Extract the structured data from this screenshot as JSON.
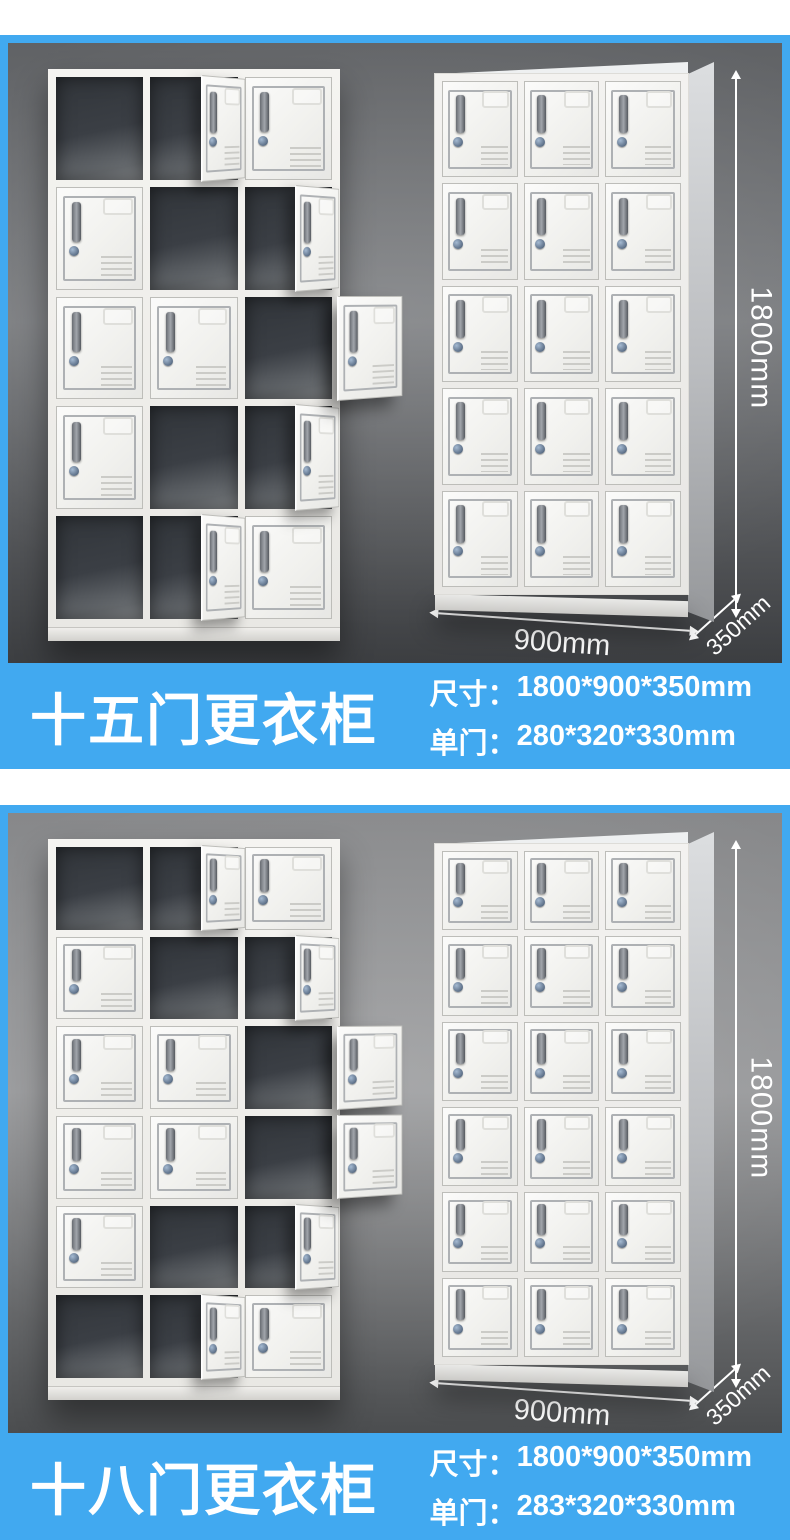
{
  "theme": {
    "banner_blue": "#41a9f0",
    "text_white": "#ffffff",
    "panel1_top": "#606265",
    "panel1_mid": "#7b7d80",
    "panel1_bottom": "#3c3e41",
    "panel2_top": "#87888a",
    "panel2_mid": "#97989a",
    "panel2_bottom": "#4b4d4f"
  },
  "sections": [
    {
      "title": "十五门更衣柜",
      "specs": [
        {
          "label": "尺寸：",
          "value": "1800*900*350mm"
        },
        {
          "label": "单门：",
          "value": "280*320*330mm"
        }
      ],
      "dimensions": {
        "height": "1800mm",
        "width": "900mm",
        "depth": "350mm"
      },
      "open_locker": {
        "cols": 3,
        "rows": 5,
        "cells": [
          [
            "open",
            "ajar",
            "closed"
          ],
          [
            "closed",
            "open",
            "ajar"
          ],
          [
            "closed",
            "closed",
            "swung"
          ],
          [
            "closed",
            "open",
            "ajar"
          ],
          [
            "open",
            "ajar",
            "closed"
          ]
        ]
      },
      "closed_locker": {
        "cols": 3,
        "rows": 5
      }
    },
    {
      "title": "十八门更衣柜",
      "specs": [
        {
          "label": "尺寸：",
          "value": "1800*900*350mm"
        },
        {
          "label": "单门：",
          "value": "283*320*330mm"
        }
      ],
      "dimensions": {
        "height": "1800mm",
        "width": "900mm",
        "depth": "350mm"
      },
      "open_locker": {
        "cols": 3,
        "rows": 6,
        "cells": [
          [
            "open",
            "ajar",
            "closed"
          ],
          [
            "closed",
            "open",
            "ajar"
          ],
          [
            "closed",
            "closed",
            "swung"
          ],
          [
            "closed",
            "closed",
            "swung"
          ],
          [
            "closed",
            "open",
            "ajar"
          ],
          [
            "open",
            "ajar",
            "closed"
          ]
        ]
      },
      "closed_locker": {
        "cols": 3,
        "rows": 6
      }
    }
  ]
}
